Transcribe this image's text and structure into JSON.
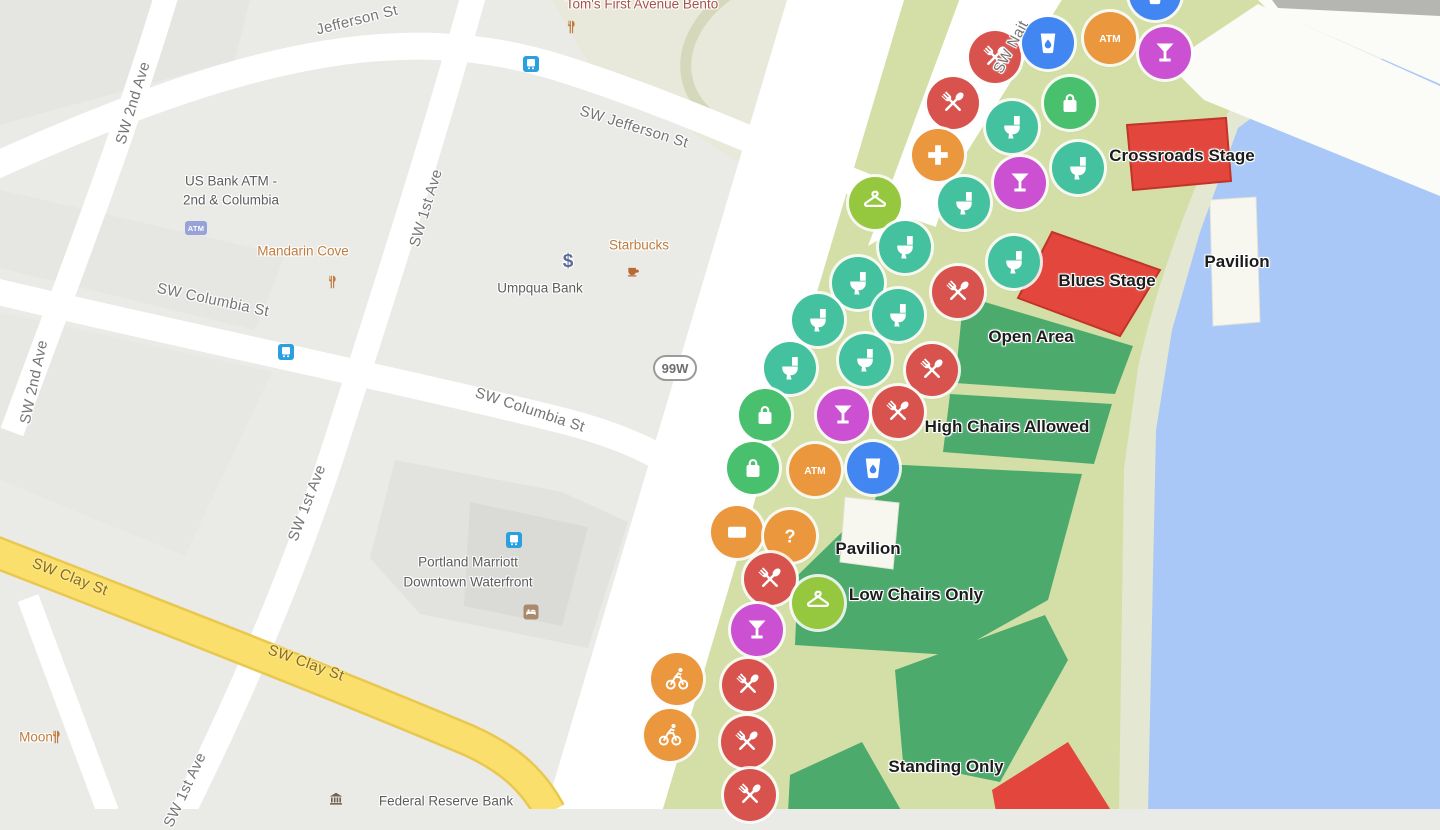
{
  "shield": {
    "text": "99W",
    "x": 675,
    "y": 368
  },
  "colors": {
    "food": "#d9534e",
    "toilet": "#44c19e",
    "bag": "#48c06e",
    "hanger": "#95c73f",
    "bar": "#cb50d2",
    "water": "#4286f2",
    "orange": "#eb973d",
    "stage_red": "#e2463c",
    "lawn_green": "#4caa6d",
    "park_green": "#d3dfa7",
    "river_blue": "#a9c8f8",
    "road_yellow": "#fadf6d"
  },
  "marker_glyphs": {
    "atm": "ATM",
    "question": "?",
    "dollar": "$",
    "atm_badge": "ATM"
  },
  "street_labels": [
    {
      "text": "Jefferson St",
      "x": 357,
      "y": 20,
      "rot": -14
    },
    {
      "text": "SW Jefferson St",
      "x": 634,
      "y": 127,
      "rot": 17
    },
    {
      "text": "SW 2nd Ave",
      "x": 133,
      "y": 103,
      "rot": -73
    },
    {
      "text": "SW 2nd Ave",
      "x": 34,
      "y": 382,
      "rot": -78
    },
    {
      "text": "SW 1st Ave",
      "x": 426,
      "y": 208,
      "rot": -73
    },
    {
      "text": "SW 1st Ave",
      "x": 307,
      "y": 503,
      "rot": -69
    },
    {
      "text": "SW 1st Ave",
      "x": 185,
      "y": 790,
      "rot": -65
    },
    {
      "text": "SW Columbia St",
      "x": 213,
      "y": 300,
      "rot": 12
    },
    {
      "text": "SW Columbia St",
      "x": 530,
      "y": 410,
      "rot": 18
    },
    {
      "text": "SW Clay St",
      "x": 70,
      "y": 577,
      "rot": 21,
      "style": "yellow"
    },
    {
      "text": "SW Clay St",
      "x": 306,
      "y": 663,
      "rot": 20,
      "style": "yellow"
    },
    {
      "text": "SW Nait",
      "x": 1011,
      "y": 47,
      "rot": -62
    }
  ],
  "poi_labels": [
    {
      "text": "Tom's First Avenue Bento",
      "x": 642,
      "y": 4,
      "color": "red"
    },
    {
      "text": "US Bank ATM -",
      "x": 231,
      "y": 181,
      "color": "gray"
    },
    {
      "text": "2nd & Columbia",
      "x": 231,
      "y": 200,
      "color": "gray"
    },
    {
      "text": "Mandarin Cove",
      "x": 303,
      "y": 251,
      "color": "orange"
    },
    {
      "text": "Starbucks",
      "x": 639,
      "y": 245,
      "color": "orange"
    },
    {
      "text": "Umpqua Bank",
      "x": 540,
      "y": 288,
      "color": "gray"
    },
    {
      "text": "Portland Marriott",
      "x": 468,
      "y": 562,
      "color": "gray"
    },
    {
      "text": "Downtown Waterfront",
      "x": 468,
      "y": 582,
      "color": "gray"
    },
    {
      "text": "Moon",
      "x": 36,
      "y": 737,
      "color": "orange"
    },
    {
      "text": "Federal Reserve Bank",
      "x": 446,
      "y": 801,
      "color": "gray"
    }
  ],
  "area_labels": [
    {
      "text": "Crossroads Stage",
      "x": 1182,
      "y": 156
    },
    {
      "text": "Pavilion",
      "x": 1237,
      "y": 262
    },
    {
      "text": "Blues Stage",
      "x": 1107,
      "y": 281
    },
    {
      "text": "Open Area",
      "x": 1031,
      "y": 337
    },
    {
      "text": "High Chairs Allowed",
      "x": 1007,
      "y": 427
    },
    {
      "text": "Pavilion",
      "x": 868,
      "y": 549
    },
    {
      "text": "Low Chairs Only",
      "x": 916,
      "y": 595
    },
    {
      "text": "Standing Only",
      "x": 946,
      "y": 767
    }
  ],
  "poi_icons": [
    {
      "type": "restaurant",
      "x": 571,
      "y": 27
    },
    {
      "type": "transit",
      "x": 531,
      "y": 64
    },
    {
      "type": "atm-badge",
      "x": 196,
      "y": 228
    },
    {
      "type": "restaurant",
      "x": 332,
      "y": 282
    },
    {
      "type": "dollar",
      "x": 568,
      "y": 262
    },
    {
      "type": "coffee",
      "x": 633,
      "y": 272
    },
    {
      "type": "transit",
      "x": 286,
      "y": 352
    },
    {
      "type": "transit",
      "x": 514,
      "y": 540
    },
    {
      "type": "hotel",
      "x": 531,
      "y": 612
    },
    {
      "type": "restaurant",
      "x": 56,
      "y": 737
    },
    {
      "type": "bank",
      "x": 336,
      "y": 799
    }
  ],
  "map_markers": [
    {
      "type": "water",
      "x": 1155,
      "y": -6
    },
    {
      "type": "food",
      "x": 995,
      "y": 57
    },
    {
      "type": "water",
      "x": 1048,
      "y": 43
    },
    {
      "type": "atm",
      "x": 1110,
      "y": 38
    },
    {
      "type": "bar",
      "x": 1165,
      "y": 53
    },
    {
      "type": "food",
      "x": 953,
      "y": 103
    },
    {
      "type": "bag",
      "x": 1070,
      "y": 103
    },
    {
      "type": "toilet",
      "x": 1012,
      "y": 127
    },
    {
      "type": "plus",
      "x": 938,
      "y": 155
    },
    {
      "type": "toilet",
      "x": 1078,
      "y": 168
    },
    {
      "type": "bar",
      "x": 1020,
      "y": 183
    },
    {
      "type": "hanger",
      "x": 875,
      "y": 203
    },
    {
      "type": "toilet",
      "x": 964,
      "y": 203
    },
    {
      "type": "toilet",
      "x": 905,
      "y": 247
    },
    {
      "type": "toilet",
      "x": 1014,
      "y": 262
    },
    {
      "type": "toilet",
      "x": 858,
      "y": 283
    },
    {
      "type": "food",
      "x": 958,
      "y": 292
    },
    {
      "type": "toilet",
      "x": 898,
      "y": 315
    },
    {
      "type": "toilet",
      "x": 818,
      "y": 320
    },
    {
      "type": "toilet",
      "x": 865,
      "y": 360
    },
    {
      "type": "toilet",
      "x": 790,
      "y": 368
    },
    {
      "type": "food",
      "x": 932,
      "y": 370
    },
    {
      "type": "bag",
      "x": 765,
      "y": 415
    },
    {
      "type": "bar",
      "x": 843,
      "y": 415
    },
    {
      "type": "food",
      "x": 898,
      "y": 412
    },
    {
      "type": "bag",
      "x": 753,
      "y": 468
    },
    {
      "type": "atm",
      "x": 815,
      "y": 470
    },
    {
      "type": "water",
      "x": 873,
      "y": 468
    },
    {
      "type": "card",
      "x": 737,
      "y": 532
    },
    {
      "type": "question",
      "x": 790,
      "y": 536
    },
    {
      "type": "food",
      "x": 770,
      "y": 579
    },
    {
      "type": "hanger",
      "x": 818,
      "y": 603
    },
    {
      "type": "bar",
      "x": 757,
      "y": 630
    },
    {
      "type": "bike",
      "x": 677,
      "y": 679
    },
    {
      "type": "food",
      "x": 748,
      "y": 685
    },
    {
      "type": "bike",
      "x": 670,
      "y": 735
    },
    {
      "type": "food",
      "x": 747,
      "y": 742
    },
    {
      "type": "food",
      "x": 750,
      "y": 795
    }
  ]
}
